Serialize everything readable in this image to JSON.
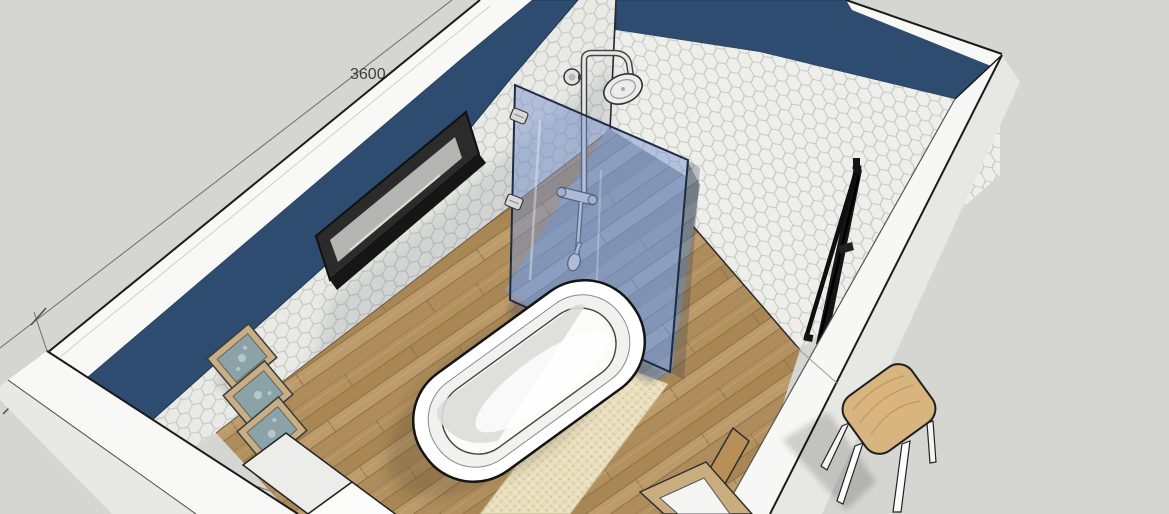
{
  "viewport": {
    "title": "Bathroom 3D model viewport",
    "dimension": {
      "label": "3600 mm"
    },
    "objects": [
      "left wall",
      "back-right wall",
      "right wall",
      "front wall",
      "walk-in shower glass panel",
      "rain shower set",
      "shower tray",
      "freestanding bathtub",
      "bath mat",
      "wall mirror",
      "gallery frames",
      "towel radiator",
      "wooden stool",
      "white cabinet",
      "leaning frame",
      "wood floor"
    ],
    "colors": {
      "background": "#d5d5d1",
      "wall_paint_navy": "#2e4c70",
      "tile": "#ebebe8",
      "tile_grout": "#c7c7c3",
      "wall_cut_white": "#f8f8f6",
      "wood_floor": "#b19060",
      "shower_floor_gray": "#99a1a8",
      "glass_blue": "#6e8cc8",
      "bath_mat": "#e9dfbf",
      "stool_wood": "#d8b47e",
      "radiator_black": "#151515",
      "frame_tan": "#c8ae85"
    }
  }
}
